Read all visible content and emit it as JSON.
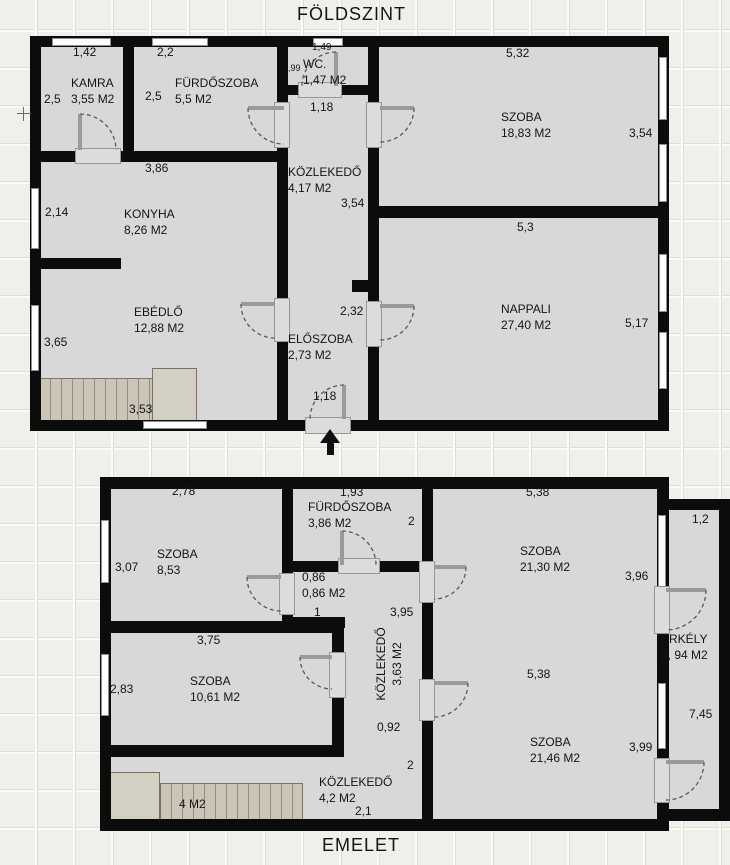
{
  "foldszint": {
    "title": "FÖLDSZINT",
    "rooms": {
      "kamra": {
        "name": "KAMRA",
        "area": "3,55 M2"
      },
      "furdo": {
        "name": "FÜRDŐSZOBA",
        "area": "5,5 M2"
      },
      "wc": {
        "name": "WC.",
        "area": "1,47 M2"
      },
      "kozlekedo": {
        "name": "KÖZLEKEDŐ",
        "area": "4,17 M2"
      },
      "szoba": {
        "name": "SZOBA",
        "area": "18,83 M2"
      },
      "konyha": {
        "name": "KONYHA",
        "area": "8,26 M2"
      },
      "ebedlo": {
        "name": "EBÉDLŐ",
        "area": "12,88 M2"
      },
      "eloszoba": {
        "name": "ELŐSZOBA",
        "area": "2,73 M2"
      },
      "nappali": {
        "name": "NAPPALI",
        "area": "27,40 M2"
      }
    },
    "dims": {
      "kamra_w": "1,42",
      "kamra_h": "2,5",
      "furdo_w": "2,2",
      "furdo_h": "2,5",
      "wc_w": "1,49",
      "wc_h": "0,99",
      "kozlekedo_w": "1,18",
      "kozlekedo_h": "3,54",
      "szoba_w": "5,32",
      "szoba_h": "3,54",
      "konyha_w": "3,86",
      "konyha_h": "2,14",
      "ebedlo_h": "3,65",
      "ebedlo_w": "3,53",
      "eloszoba_h": "2,32",
      "entrance_w": "1,18",
      "nappali_w": "5,3",
      "nappali_h": "5,17"
    }
  },
  "emelet": {
    "title": "EMELET",
    "rooms": {
      "szoba1": {
        "name": "SZOBA",
        "area": "8,53"
      },
      "furdo": {
        "name": "FÜRDŐSZOBA",
        "area": "3,86 M2"
      },
      "kamra086": {
        "name": "0,86",
        "area": "0,86 M2"
      },
      "kozlekedo": {
        "name": "KÖZLEKEDŐ",
        "area": "3,63 M2"
      },
      "szoba2": {
        "name": "SZOBA",
        "area": "21,30 M2"
      },
      "erkely": {
        "name": "ERKÉLY",
        "area": "8, 94 M2"
      },
      "szoba3": {
        "name": "SZOBA",
        "area": "21,46 M2"
      },
      "szoba4": {
        "name": "SZOBA",
        "area": "10,61 M2"
      },
      "kozlekedo2": {
        "name": "KÖZLEKEDŐ",
        "area": "4,2 M2"
      },
      "stairs": {
        "area": "4 M2"
      }
    },
    "dims": {
      "szoba1_w": "2,78",
      "szoba1_h": "3,07",
      "furdo_w": "1,93",
      "furdo_h": "2",
      "kamra086_d": "1",
      "kozlekedo_l": "3,95",
      "kozlekedo_b": "0,92",
      "kozlekedo_r": "2",
      "szoba2_w": "5,38",
      "szoba2_h": "3,96",
      "erkely_w": "1,2",
      "erkely_h": "7,45",
      "szoba3_w": "5,38",
      "szoba3_h": "3,99",
      "szoba4_w": "3,75",
      "szoba4_h": "2,83",
      "kozlekedo2_w": "2,1"
    }
  }
}
